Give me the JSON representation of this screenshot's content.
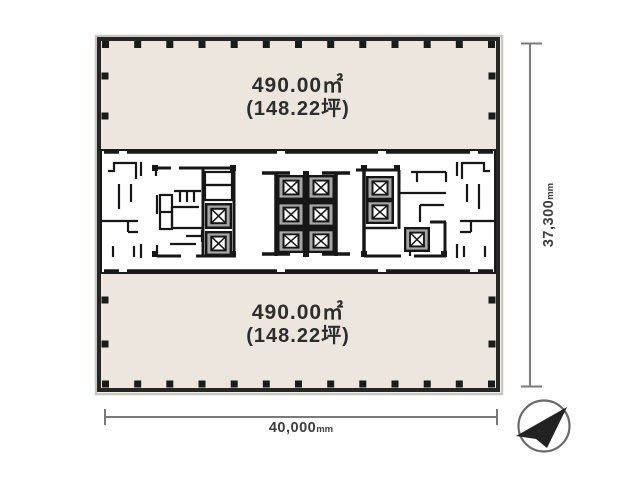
{
  "floor_plan": {
    "upper_zone": {
      "area_sqm": "490.00㎡",
      "area_tsubo": "(148.22坪)"
    },
    "lower_zone": {
      "area_sqm": "490.00㎡",
      "area_tsubo": "(148.22坪)"
    },
    "dimensions": {
      "width": {
        "value": "40,000",
        "unit": "mm"
      },
      "height": {
        "value": "37,300",
        "unit": "mm"
      }
    },
    "compass": {
      "icon": "north-arrow-compass-icon",
      "pointing": "upper-right"
    },
    "colors": {
      "floor_fill": "#ECE6DF",
      "wall": "#262626",
      "core_fill": "#FFFFFF",
      "shaft_gray": "#A7A7A7",
      "dimension_line": "#7A7A7A",
      "label_text": "#2D2D2D"
    }
  }
}
